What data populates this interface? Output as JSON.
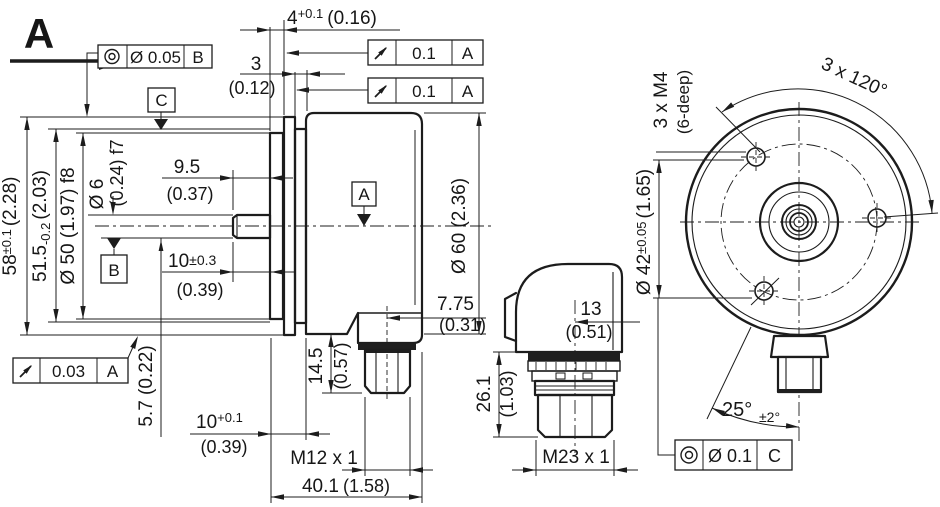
{
  "drawing": {
    "bg_color": "#ffffff",
    "line_color": "#1c1c1c",
    "view_direction_label": "A"
  },
  "side_view": {
    "dim_pilot_depth": "4",
    "dim_pilot_depth_tol": "+0.1",
    "dim_pilot_depth_inch": "(0.16)",
    "dim_gap": "3",
    "dim_gap_inch": "(0.12)",
    "dim_housing": "58",
    "dim_housing_tol": "±0.1",
    "dim_housing_inch": "(2.28)",
    "dim_flange": "51.5",
    "dim_flange_tol": "-0.2",
    "dim_flange_inch": "(2.03)",
    "dim_collar": "Ø 50 (1.97) f8",
    "dim_shaft_dia": "Ø 6",
    "dim_shaft_dia_inch_fit": "(0.24) f7",
    "dim_shaft_usable": "9.5",
    "dim_shaft_usable_inch": "(0.37)",
    "dim_shaft_len": "10",
    "dim_shaft_len_tol": "±0.3",
    "dim_shaft_len_inch": "(0.39)",
    "dim_flat": "5.7 (0.22)",
    "dim_mount_depth": "10",
    "dim_mount_depth_tol": "+0.1",
    "dim_mount_depth_inch": "(0.39)",
    "dim_conn_thread": "M12 x 1",
    "dim_body_len": "40.1",
    "dim_body_len_inch": "(1.58)",
    "dim_conn_height": "14.5",
    "dim_conn_height_inch": "(0.57)",
    "dim_conn_offset": "7.75",
    "dim_conn_offset_inch": "(0.31)",
    "dim_body_dia": "Ø 60 (2.36)"
  },
  "gdt": {
    "frame_concentricity_shaft": {
      "icon": "concentricity-icon",
      "value": "Ø 0.05",
      "datum": "B"
    },
    "frame_runout_1": {
      "icon": "circular-runout-icon",
      "value": "0.1",
      "datum": "A"
    },
    "frame_runout_2": {
      "icon": "circular-runout-icon",
      "value": "0.1",
      "datum": "A"
    },
    "frame_runout_shaft": {
      "icon": "circular-runout-icon",
      "value": "0.03",
      "datum": "A"
    },
    "frame_position_holes": {
      "icon": "concentricity-icon",
      "value": "Ø 0.1",
      "datum": "C"
    },
    "datum_a": "A",
    "datum_b": "B",
    "datum_c": "C"
  },
  "connector_view": {
    "dim_offset": "13",
    "dim_offset_inch": "(0.51)",
    "dim_height": "26.1",
    "dim_height_inch": "(1.03)",
    "dim_thread": "M23 x 1"
  },
  "rear_view": {
    "dim_holes": "3 x M4",
    "dim_holes_depth": "(6-deep)",
    "dim_spacing": "3 x 120°",
    "dim_bolt_circle": "Ø 42",
    "dim_bolt_circle_tol": "±0.05",
    "dim_bolt_circle_inch": "(1.65)",
    "dim_angle": "25°",
    "dim_angle_tol": "±2°"
  }
}
